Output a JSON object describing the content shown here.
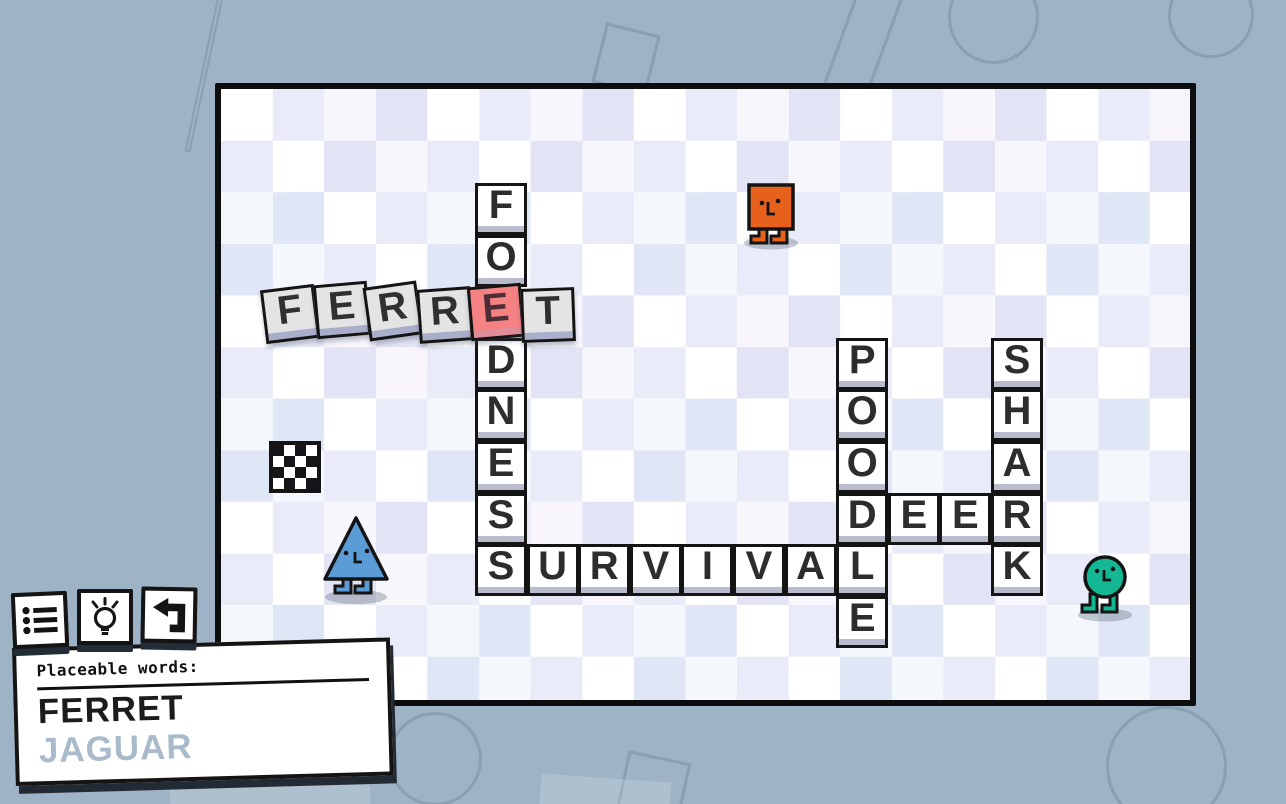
{
  "board": {
    "grid": {
      "origin_x": 268.6,
      "origin_y": 183,
      "cell": 51.6
    },
    "placed_words": [
      {
        "word": "FONDNESS",
        "direction": "vertical",
        "col": 4,
        "row": 0,
        "hidden_indices": [
          2
        ]
      },
      {
        "word": "SURVIVAL",
        "direction": "horizontal",
        "col": 4,
        "row": 7,
        "hidden_indices": []
      },
      {
        "word": "POODLE",
        "direction": "vertical",
        "col": 11,
        "row": 3,
        "hidden_indices": []
      },
      {
        "word": "DEER",
        "direction": "horizontal",
        "col": 11,
        "row": 6,
        "hidden_indices": []
      },
      {
        "word": "SHARK",
        "direction": "vertical",
        "col": 14,
        "row": 3,
        "hidden_indices": []
      }
    ],
    "drag_word": {
      "word": "FERRET",
      "conflict_index": 4,
      "tiles": [
        {
          "x": 263,
          "y": 287,
          "rot": -7
        },
        {
          "x": 314.5,
          "y": 283,
          "rot": -5
        },
        {
          "x": 366,
          "y": 284,
          "rot": -8
        },
        {
          "x": 417.5,
          "y": 288,
          "rot": -4
        },
        {
          "x": 469,
          "y": 285,
          "rot": -5
        },
        {
          "x": 520.5,
          "y": 288,
          "rot": -2
        }
      ]
    },
    "flag_tile": {
      "col": 0,
      "row": 5
    },
    "characters": [
      {
        "name": "square-character",
        "color": "#e8611c"
      },
      {
        "name": "triangle-character",
        "color": "#5b9cd6"
      },
      {
        "name": "circle-character",
        "color": "#14b794"
      }
    ]
  },
  "toolbar": {
    "buttons": [
      {
        "name": "word-list-button",
        "icon": "list-icon"
      },
      {
        "name": "hint-button",
        "icon": "lightbulb-icon"
      },
      {
        "name": "undo-button",
        "icon": "undo-arrow-icon"
      }
    ]
  },
  "placeable_panel": {
    "title": "Placeable words:",
    "words": [
      {
        "text": "FERRET",
        "active": true
      },
      {
        "text": "JAGUAR",
        "active": false
      }
    ]
  },
  "colors": {
    "background": "#9eb3c5",
    "tile_face": "#ffffff",
    "tile_edge": "#b8bccd",
    "drag_tile_face": "#e4e4e4",
    "drag_tile_edge": "#a9aecb",
    "conflict_face": "#f58282",
    "conflict_edge": "#de8d99",
    "letter": "#2d2d2d",
    "inactive_word": "#a9bbca"
  }
}
